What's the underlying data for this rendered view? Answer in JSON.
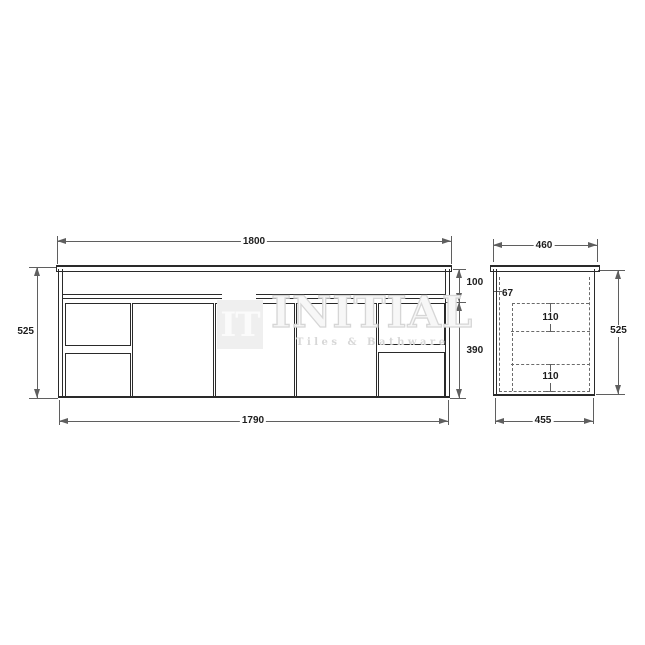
{
  "watermark": {
    "logo_text": "IT",
    "brand_name": "INITIAL",
    "tagline": "Tiles & Bathware"
  },
  "front_view": {
    "width_top": "1800",
    "width_bottom": "1790",
    "height_overall": "525",
    "top_section_height": "100",
    "lower_section_height": "390"
  },
  "side_view": {
    "width_top": "460",
    "width_bottom": "455",
    "height_overall": "525",
    "front_offset": "67",
    "drawer_upper_depth": "110",
    "drawer_lower_depth": "110"
  },
  "colors": {
    "line": "#2a2a2a",
    "dim": "#5f5f5f",
    "text": "#1d1d1d",
    "watermark": "#e4e4e4",
    "background": "#ffffff"
  }
}
